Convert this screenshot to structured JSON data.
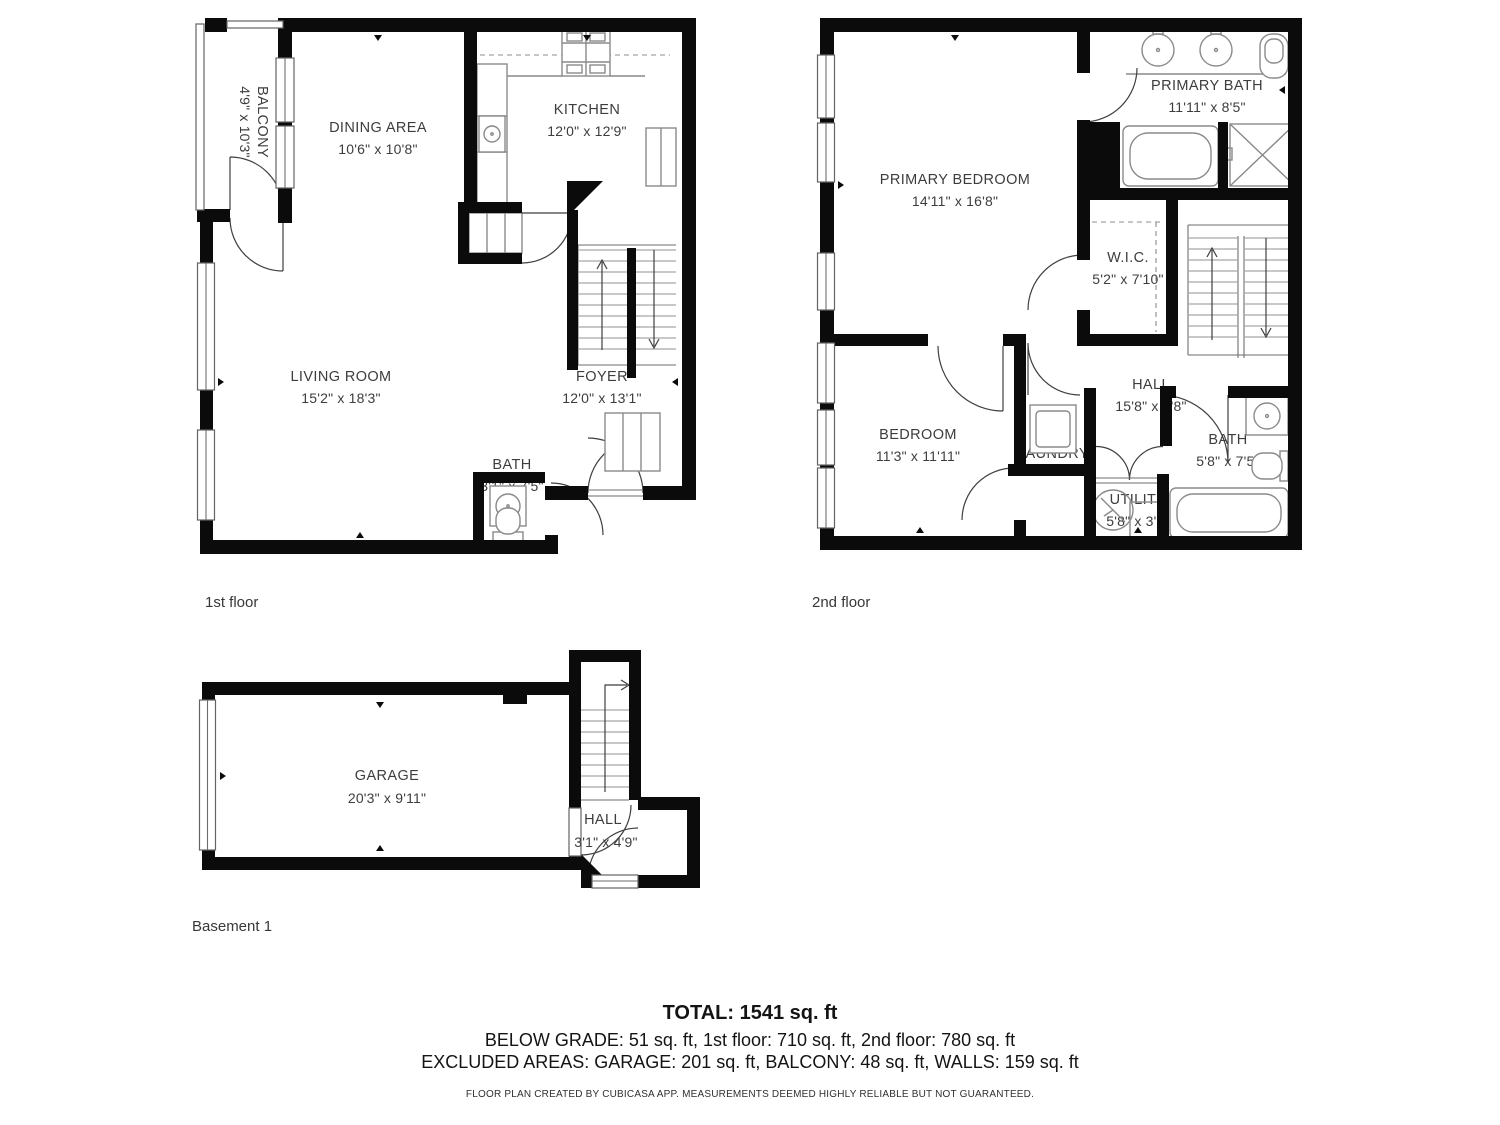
{
  "floors": [
    {
      "label": "1st floor",
      "rooms": [
        {
          "name": "BALCONY",
          "dims": "4'9\" x 10'3\""
        },
        {
          "name": "DINING AREA",
          "dims": "10'6\" x 10'8\""
        },
        {
          "name": "KITCHEN",
          "dims": "12'0\" x 12'9\""
        },
        {
          "name": "LIVING ROOM",
          "dims": "15'2\" x 18'3\""
        },
        {
          "name": "FOYER",
          "dims": "12'0\" x 13'1\""
        },
        {
          "name": "BATH",
          "dims": "3'1\" x 7'5\""
        }
      ]
    },
    {
      "label": "2nd floor",
      "rooms": [
        {
          "name": "PRIMARY BEDROOM",
          "dims": "14'11\" x 16'8\""
        },
        {
          "name": "PRIMARY BATH",
          "dims": "11'11\" x 8'5\""
        },
        {
          "name": "W.I.C.",
          "dims": "5'2\" x 7'10\""
        },
        {
          "name": "HALL",
          "dims": "15'8\" x 8'8\""
        },
        {
          "name": "BEDROOM",
          "dims": "11'3\" x 11'11\""
        },
        {
          "name": "LAUNDRY",
          "dims": "3'7\" x 3'2\""
        },
        {
          "name": "UTILITY",
          "dims": "5'8\" x 3'0\""
        },
        {
          "name": "BATH",
          "dims": "5'8\" x 7'5\""
        }
      ]
    },
    {
      "label": "Basement 1",
      "rooms": [
        {
          "name": "GARAGE",
          "dims": "20'3\" x 9'11\""
        },
        {
          "name": "HALL",
          "dims": "3'1\" x 4'9\""
        }
      ]
    }
  ],
  "summary": {
    "total": "TOTAL: 1541 sq. ft",
    "areas_line": "BELOW GRADE: 51 sq. ft, 1st floor: 710 sq. ft, 2nd floor: 780 sq. ft",
    "excluded_line": "EXCLUDED AREAS: GARAGE: 201 sq. ft, BALCONY: 48 sq. ft, WALLS: 159 sq. ft",
    "disclaimer": "FLOOR PLAN CREATED BY CUBICASA APP. MEASUREMENTS DEEMED HIGHLY RELIABLE BUT NOT GUARANTEED."
  },
  "colors": {
    "wall": "#0b0b0b",
    "fixture": "#8a8a8a",
    "room_text": "#3d3d3d",
    "background": "#ffffff"
  }
}
